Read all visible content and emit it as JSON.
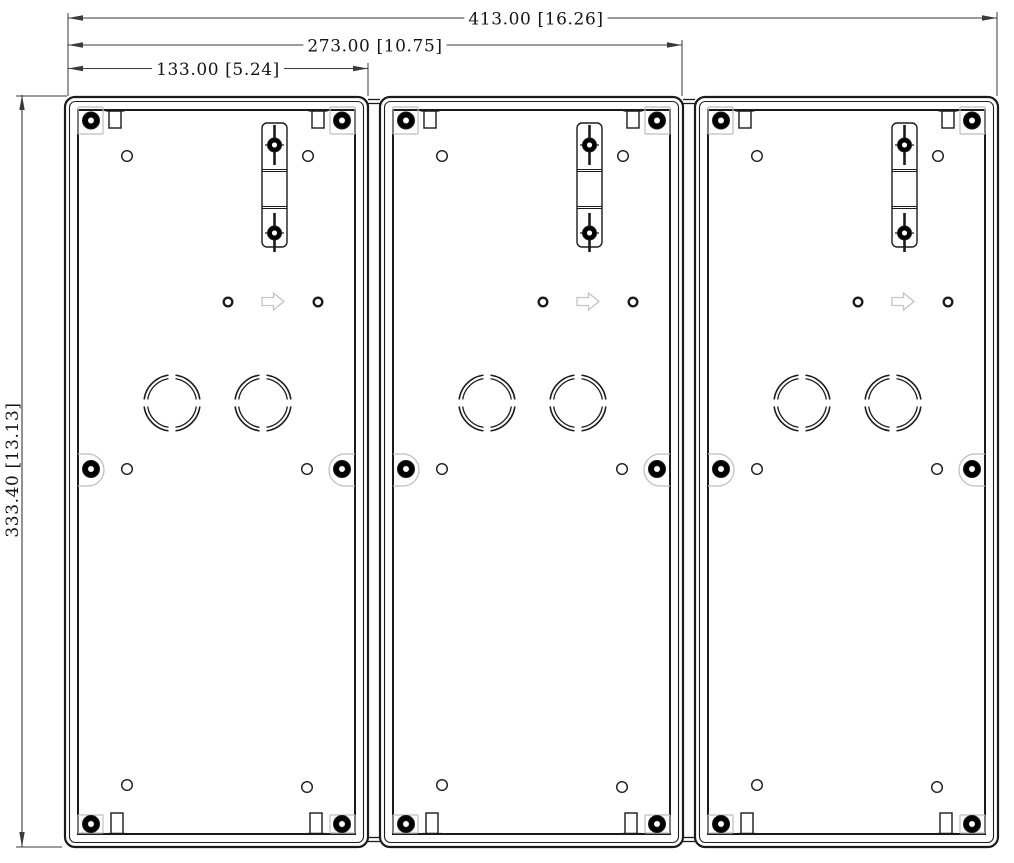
{
  "drawing": {
    "type": "technical-dimension-drawing",
    "subject": "three-gang surface-mount back boxes, rear view",
    "units": "mm [in]",
    "colors": {
      "line": "#1b1b1b",
      "dim": "#3a3a3a",
      "pad": "#bdbdbd",
      "arrow_glyph": "#c4c4c4",
      "background": "#ffffff"
    },
    "dimensions": [
      {
        "id": "overall-width",
        "label": "413.00 [16.26]",
        "orientation": "horizontal",
        "y": 18,
        "x1": 68,
        "x2": 997,
        "text_x": 536
      },
      {
        "id": "two-gang-width",
        "label": "273.00 [10.75]",
        "orientation": "horizontal",
        "y": 45,
        "x1": 68,
        "x2": 682,
        "text_x": 375
      },
      {
        "id": "one-gang-width",
        "label": "133.00 [5.24]",
        "orientation": "horizontal",
        "y": 68.5,
        "x1": 68,
        "x2": 368,
        "text_x": 218
      },
      {
        "id": "overall-height",
        "label": "333.40 [13.13]",
        "orientation": "vertical",
        "x": 22,
        "y1": 95,
        "y2": 847,
        "text_y": 470
      }
    ],
    "extension_lines": [
      [
        68,
        13,
        68,
        96
      ],
      [
        368,
        63,
        368,
        96
      ],
      [
        682,
        40,
        682,
        96
      ],
      [
        997,
        12,
        997,
        96
      ],
      [
        16,
        96,
        67,
        96
      ],
      [
        16,
        847,
        62,
        847
      ]
    ],
    "boxes": {
      "count": 3,
      "x_positions": [
        65,
        380,
        695
      ],
      "top": 97,
      "width": 303,
      "height": 750,
      "gap_bridges": [
        {
          "x1": 368,
          "x2": 380
        },
        {
          "x1": 683,
          "x2": 695
        }
      ],
      "bridge_y": [
        99.5,
        103.5,
        837.5,
        841.5
      ]
    },
    "box_features": {
      "outer_rect": {
        "x": 0,
        "y": 0,
        "w": 303,
        "h": 750,
        "rx": 10
      },
      "inset_rect": {
        "x": 4.5,
        "y": 4.5,
        "w": 294,
        "h": 741,
        "rx": 6
      },
      "inner_rect": {
        "x": 13,
        "y": 13,
        "w": 277,
        "h": 724
      },
      "corner_pads": [
        [
          13,
          10,
          25,
          27
        ],
        [
          265,
          10,
          25,
          27
        ],
        [
          13,
          718,
          25,
          18
        ],
        [
          265,
          718,
          25,
          18
        ]
      ],
      "corner_screws": [
        [
          26,
          23.5
        ],
        [
          277,
          23.5
        ],
        [
          26,
          727
        ],
        [
          277,
          727
        ]
      ],
      "side_pad_y": 357,
      "side_pad_h": 32,
      "side_screws": [
        [
          26,
          372
        ],
        [
          277,
          372
        ]
      ],
      "top_slots_x": [
        44,
        247
      ],
      "bottom_slots_x": [
        46,
        245
      ],
      "small_holes": [
        [
          62,
          59
        ],
        [
          243,
          59
        ],
        [
          62,
          372
        ],
        [
          242,
          372
        ],
        [
          62,
          688
        ],
        [
          242,
          690
        ]
      ],
      "bold_holes": [
        [
          163,
          205
        ],
        [
          253,
          205
        ]
      ],
      "knockouts": {
        "centers": [
          [
            107,
            306
          ],
          [
            198,
            306
          ]
        ],
        "r_outer": 28,
        "r_inner": 24.5
      },
      "rail": {
        "x": 197,
        "y": 26,
        "w": 25,
        "h": 124,
        "rx": 5,
        "center_x": 209.5,
        "screw_y": [
          48,
          136
        ],
        "divider_y": [
          72.5,
          109.5
        ],
        "rod_segments": [
          [
            28,
            68
          ],
          [
            116,
            155
          ]
        ]
      },
      "direction_arrow": {
        "x": 197,
        "cy": 204.5,
        "tip_x": 219
      }
    }
  }
}
